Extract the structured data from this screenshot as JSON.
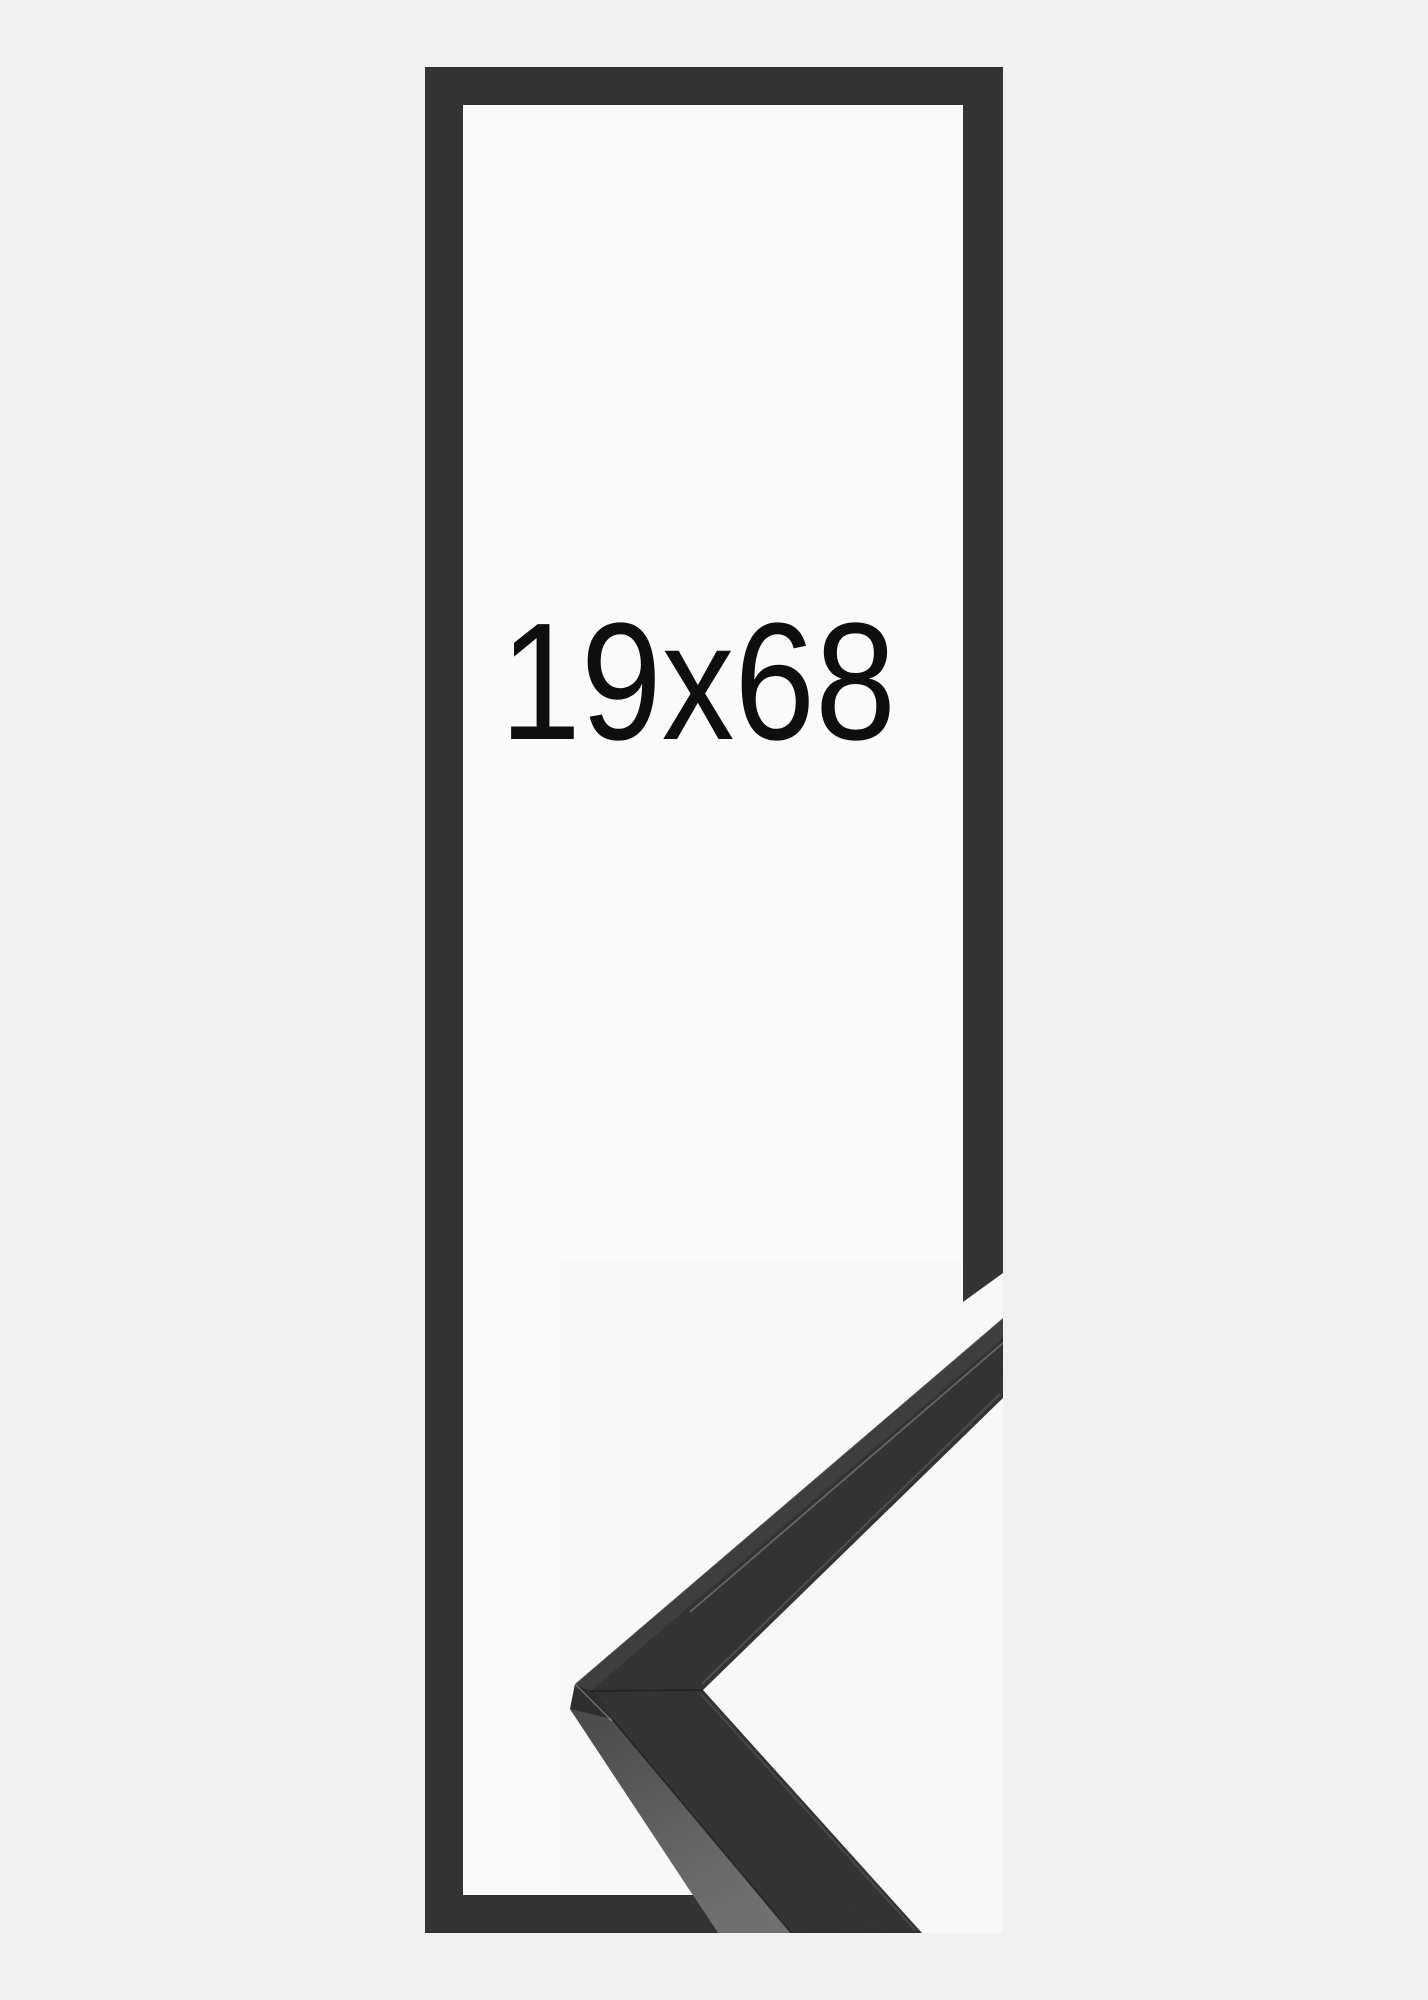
{
  "product_image": {
    "size_label": "19x68"
  },
  "colors": {
    "page_background": "#f1f1f2",
    "canvas_white": "#fafafa",
    "photo_background": "#f8f8f9",
    "frame_outline": "#343434",
    "moulding_face": "#303030",
    "moulding_top_band": "#3b3b3b",
    "moulding_side_band_top": "#474747",
    "moulding_side_band_bottom": "#6e6e6e",
    "moulding_apex_facet": "#2b2b2b",
    "size_label_color": "#0e0e0e"
  }
}
